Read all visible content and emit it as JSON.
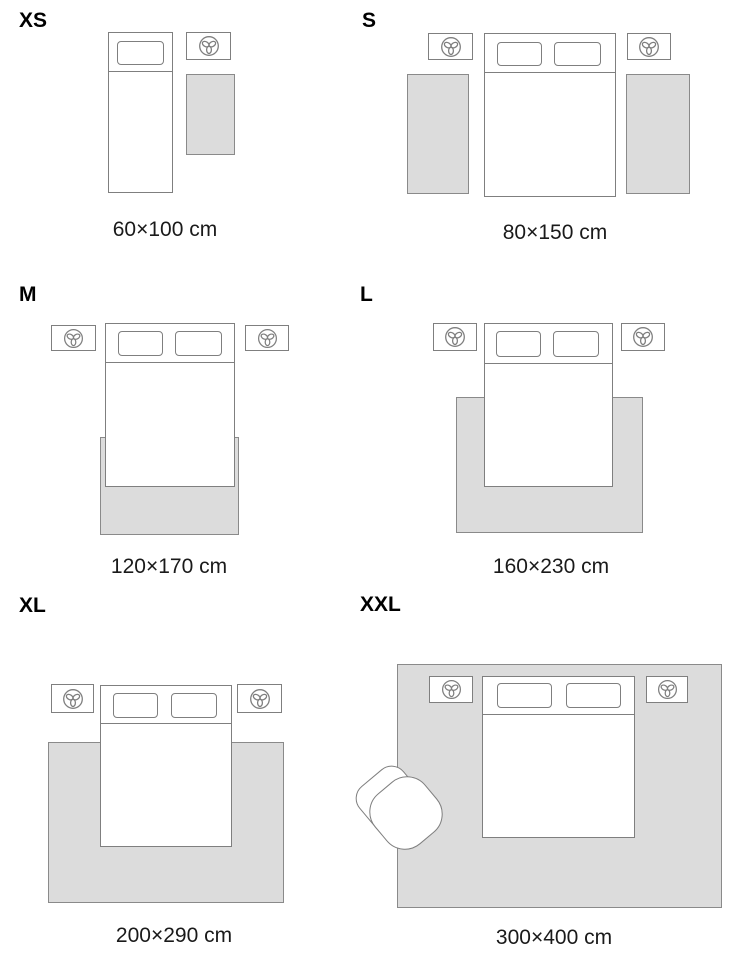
{
  "title": "Rug size guide",
  "colors": {
    "outline": "#7f7f7f",
    "rug_fill": "#dcdcdc",
    "rug_border": "#8a8a8a",
    "text": "#1a1a1a",
    "background": "#ffffff"
  },
  "icons": {
    "nightstand_icon": "plant-icon"
  },
  "sizes": [
    {
      "code": "XS",
      "dimensions": "60×100 cm"
    },
    {
      "code": "S",
      "dimensions": "80×150 cm"
    },
    {
      "code": "M",
      "dimensions": "120×170 cm"
    },
    {
      "code": "L",
      "dimensions": "160×230 cm"
    },
    {
      "code": "XL",
      "dimensions": "200×290 cm"
    },
    {
      "code": "XXL",
      "dimensions": "300×400 cm"
    }
  ]
}
